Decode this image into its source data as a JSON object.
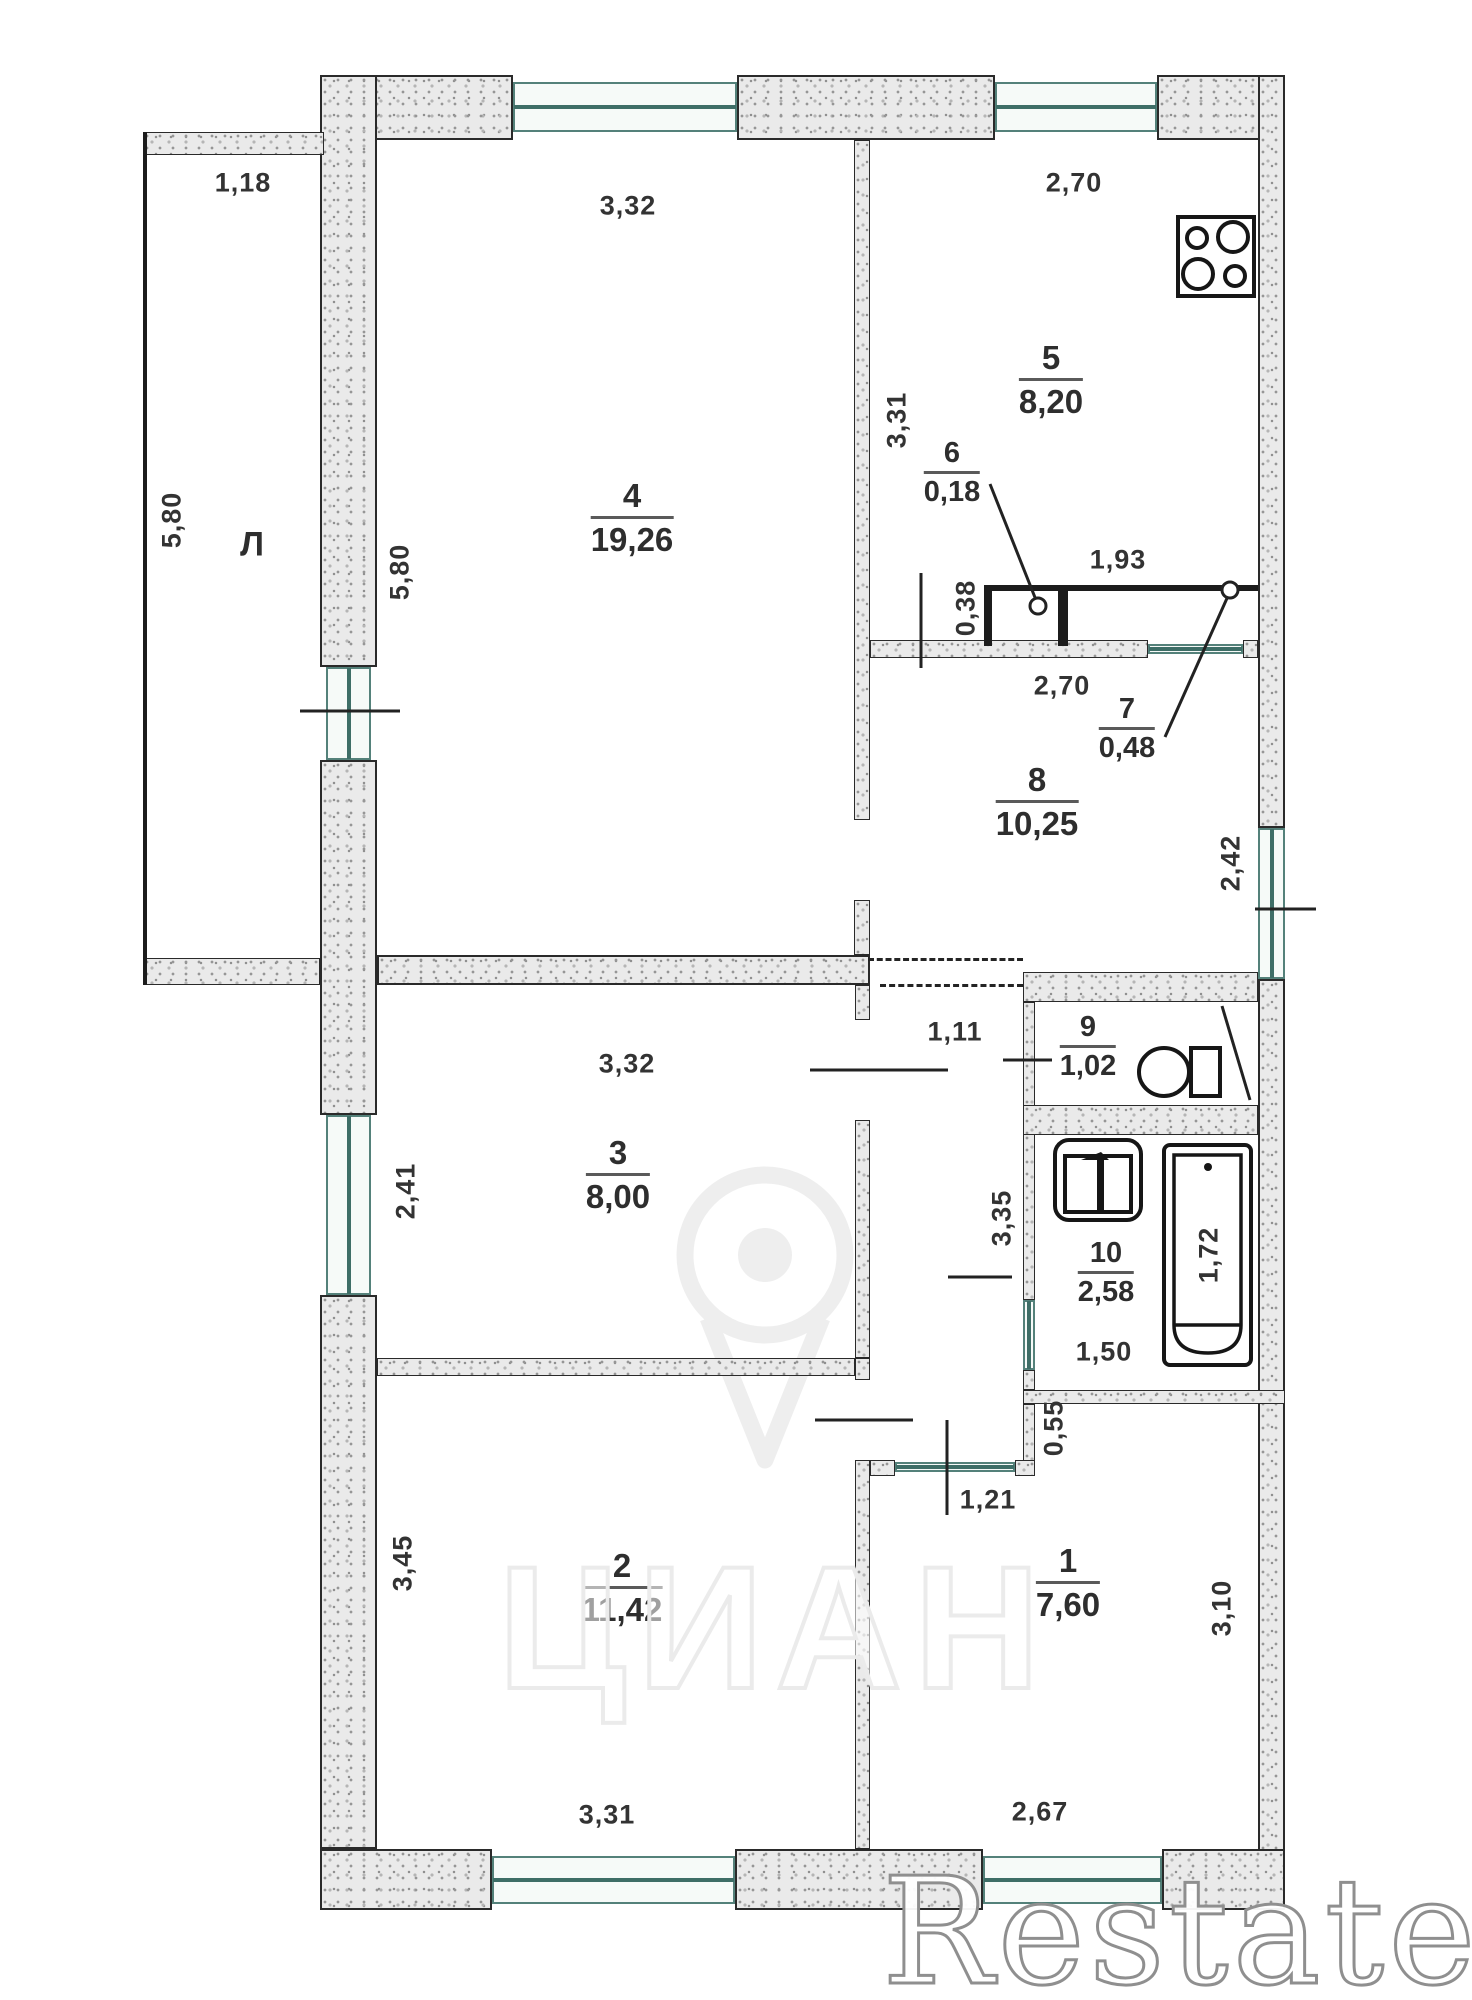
{
  "balcony": {
    "label": "Л",
    "width": "1,18",
    "height": "5,80"
  },
  "rooms": {
    "r1": {
      "number": "1",
      "area": "7,60"
    },
    "r2": {
      "number": "2",
      "area": "11,42"
    },
    "r3": {
      "number": "3",
      "area": "8,00"
    },
    "r4": {
      "number": "4",
      "area": "19,26"
    },
    "r5": {
      "number": "5",
      "area": "8,20"
    },
    "r6": {
      "number": "6",
      "area": "0,18"
    },
    "r7": {
      "number": "7",
      "area": "0,48"
    },
    "r8": {
      "number": "8",
      "area": "10,25"
    },
    "r9": {
      "number": "9",
      "area": "1,02"
    },
    "r10": {
      "number": "10",
      "area": "2,58"
    }
  },
  "dims": {
    "room4_top": "3,32",
    "room4_side": "5,80",
    "kitchen_top": "2,70",
    "kitchen_side": "3,31",
    "closet_w": "1,93",
    "closet_d": "0,38",
    "hall_top": "2,70",
    "hall_window": "2,42",
    "room3_top": "3,32",
    "room3_window": "2,41",
    "corridor_top": "1,11",
    "corridor_side": "3,35",
    "tub": "1,72",
    "bath_w": "1,50",
    "stub": "0,55",
    "door": "1,21",
    "room2_side": "3,45",
    "room2_bottom": "3,31",
    "room1_bottom": "2,67",
    "room1_side": "3,10"
  },
  "watermarks": {
    "cian": "ЦИАН",
    "restate": "Restate"
  }
}
